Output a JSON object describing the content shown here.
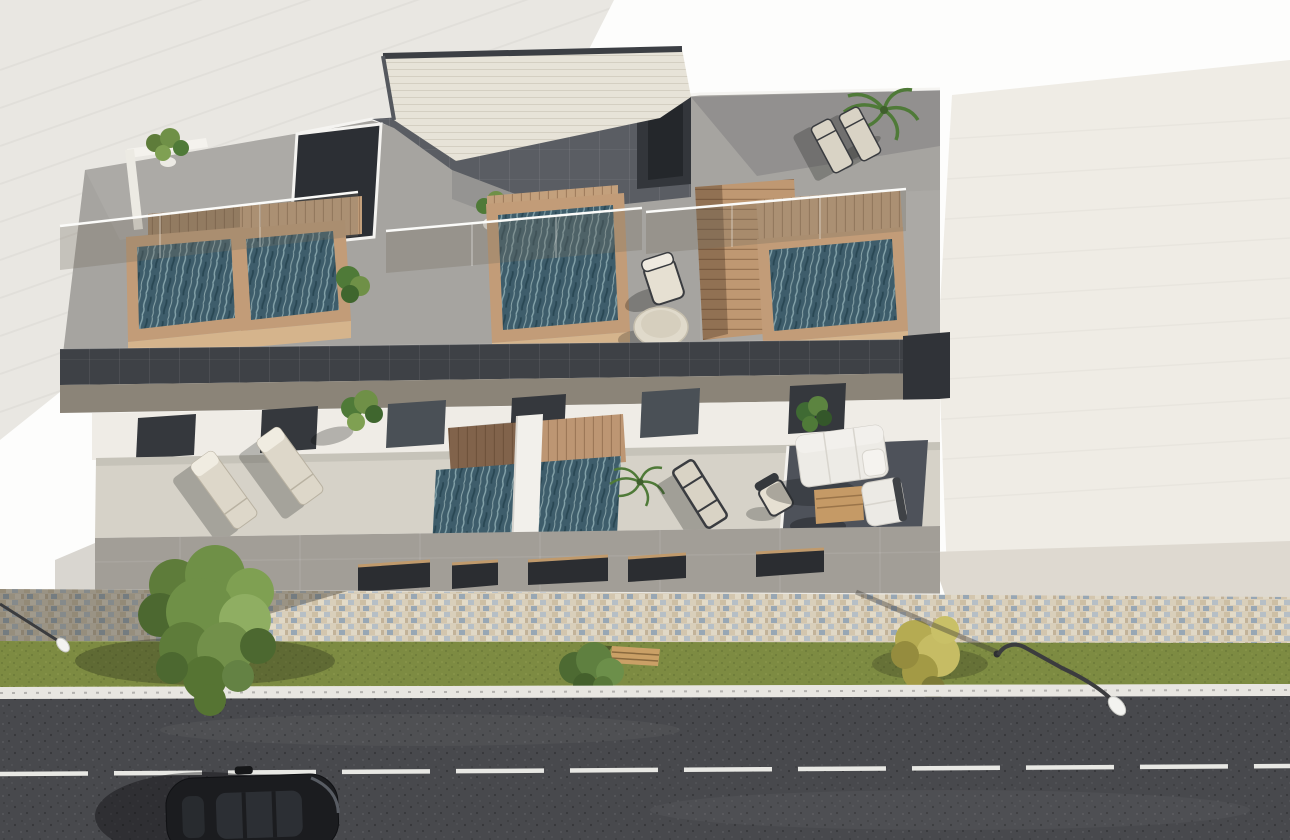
{
  "labels": {
    "scene": "Aerial 3D architectural rendering of a modern two-level residential building with three rooftop plunge pools and furnished terraces, facing a street with a mosaic sidewalk, grass verge, trees, street lamps and a passing black car",
    "building": "Modern white and grey flat-roof building with glass balustrades, wooden pool decks and a central rooftop stair block",
    "street": "Street zone with patterned paver sidewalk, green verge with bench and bushes, white curb and dark asphalt road with dashed lane line"
  },
  "scene": {
    "view": "aerial three-quarter top-down",
    "time_of_day": "sunny daylight, hard shadows falling to the lower-left",
    "counts": {
      "rooftop_pools": 3,
      "lower_terrace_pools": 1,
      "sun_loungers": 5,
      "chairs": 3,
      "sofas": 1,
      "coffee_tables": 1,
      "round_tables": 1,
      "potted_plants": 7,
      "street_trees": 1,
      "bushes": 2,
      "benches": 1,
      "street_lamps": 2,
      "cars": 1
    },
    "materials": [
      "cream brick roof block",
      "dark grey panel fascia",
      "glass balustrades",
      "teak pool decks",
      "beige terrace tiles",
      "multicolor mosaic pavers",
      "asphalt"
    ]
  },
  "palette": {
    "background": "#fdfdfc",
    "leftRoof": "#e9e7e2",
    "rightRoof": "#efece5",
    "rightRoofBand": "#ded9d0",
    "roofDeck": "#a6a4a0",
    "fasciaDark": "#3e4146",
    "fasciaTaupe": "#8b8478",
    "penthouseTop": "#e7e3d8",
    "penthousePanel": "#5a5d63",
    "stairVoid": "#2c2f34",
    "woodDeck": "#c3a07c",
    "poolRim": "#c29c78",
    "poolFront": "#d5b48c",
    "waterBase": "#3e5d6b",
    "glassTint": "rgba(115,108,96,0.30)",
    "wallWhite": "#efece6",
    "doorDark": "#35383d",
    "terraceFloor": "#d6d2c8",
    "terraceDark": "#4e525a",
    "facadeBand": "#a29e97",
    "windowDark": "#2b2d31",
    "windowLintel": "#c09a6c",
    "mosaicBase": "#d8cebb",
    "grass": "#7d8b42",
    "curb": "#e8e6e1",
    "asphalt": "#48494d",
    "laneLine": "#e8e8e4",
    "carBody": "#1b1c1f",
    "carGlass": "#2c2f34",
    "lampPole": "#3b3c3e",
    "lampHead": "#f3f3f0",
    "treeGreen": "#6f9047",
    "benchWood": "#caa066",
    "bushYellow": "#b5ab52",
    "bushGreen": "#5f8040",
    "sofaWhite": "#edebe6",
    "tableWood": "#c59a66",
    "loungerPad": "#ddd7c9",
    "loungerFrame": "#3a3c40",
    "plantGreen": "#4f7a38",
    "potWhite": "#eceae4"
  }
}
